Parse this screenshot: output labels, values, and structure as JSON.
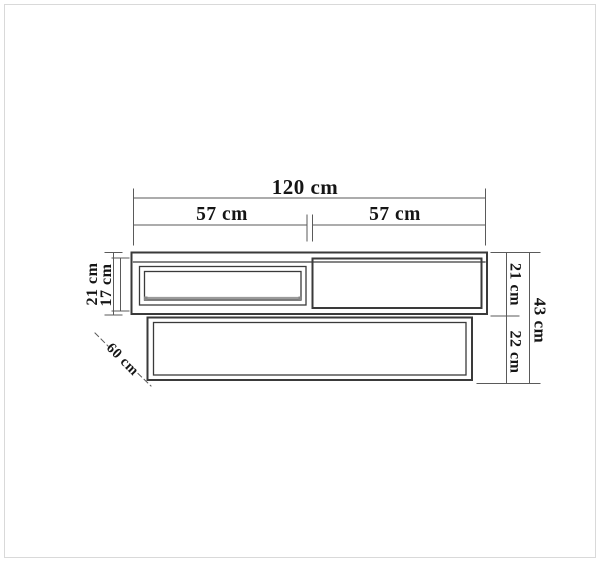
{
  "page": {
    "background": "#ffffff",
    "frame_color": "#d9d9d9"
  },
  "drawing": {
    "kind": "furniture-dimension-diagram",
    "view": "front-elevation",
    "colors": {
      "outline": "#3a3a3a",
      "dimension_line": "#5a5a5a",
      "label_text": "#151515",
      "shelf_rail": "#9b9b9b",
      "rail_end": "#868686"
    },
    "dimensions": {
      "top_total_width": "120 cm",
      "top_left_section": "57 cm",
      "top_right_section": "57 cm",
      "left_unit_height": "21 cm",
      "left_opening_height": "17 cm",
      "right_upper_height": "21 cm",
      "right_lower_height": "22 cm",
      "right_total_height": "43 cm",
      "depth": "60 cm"
    }
  }
}
